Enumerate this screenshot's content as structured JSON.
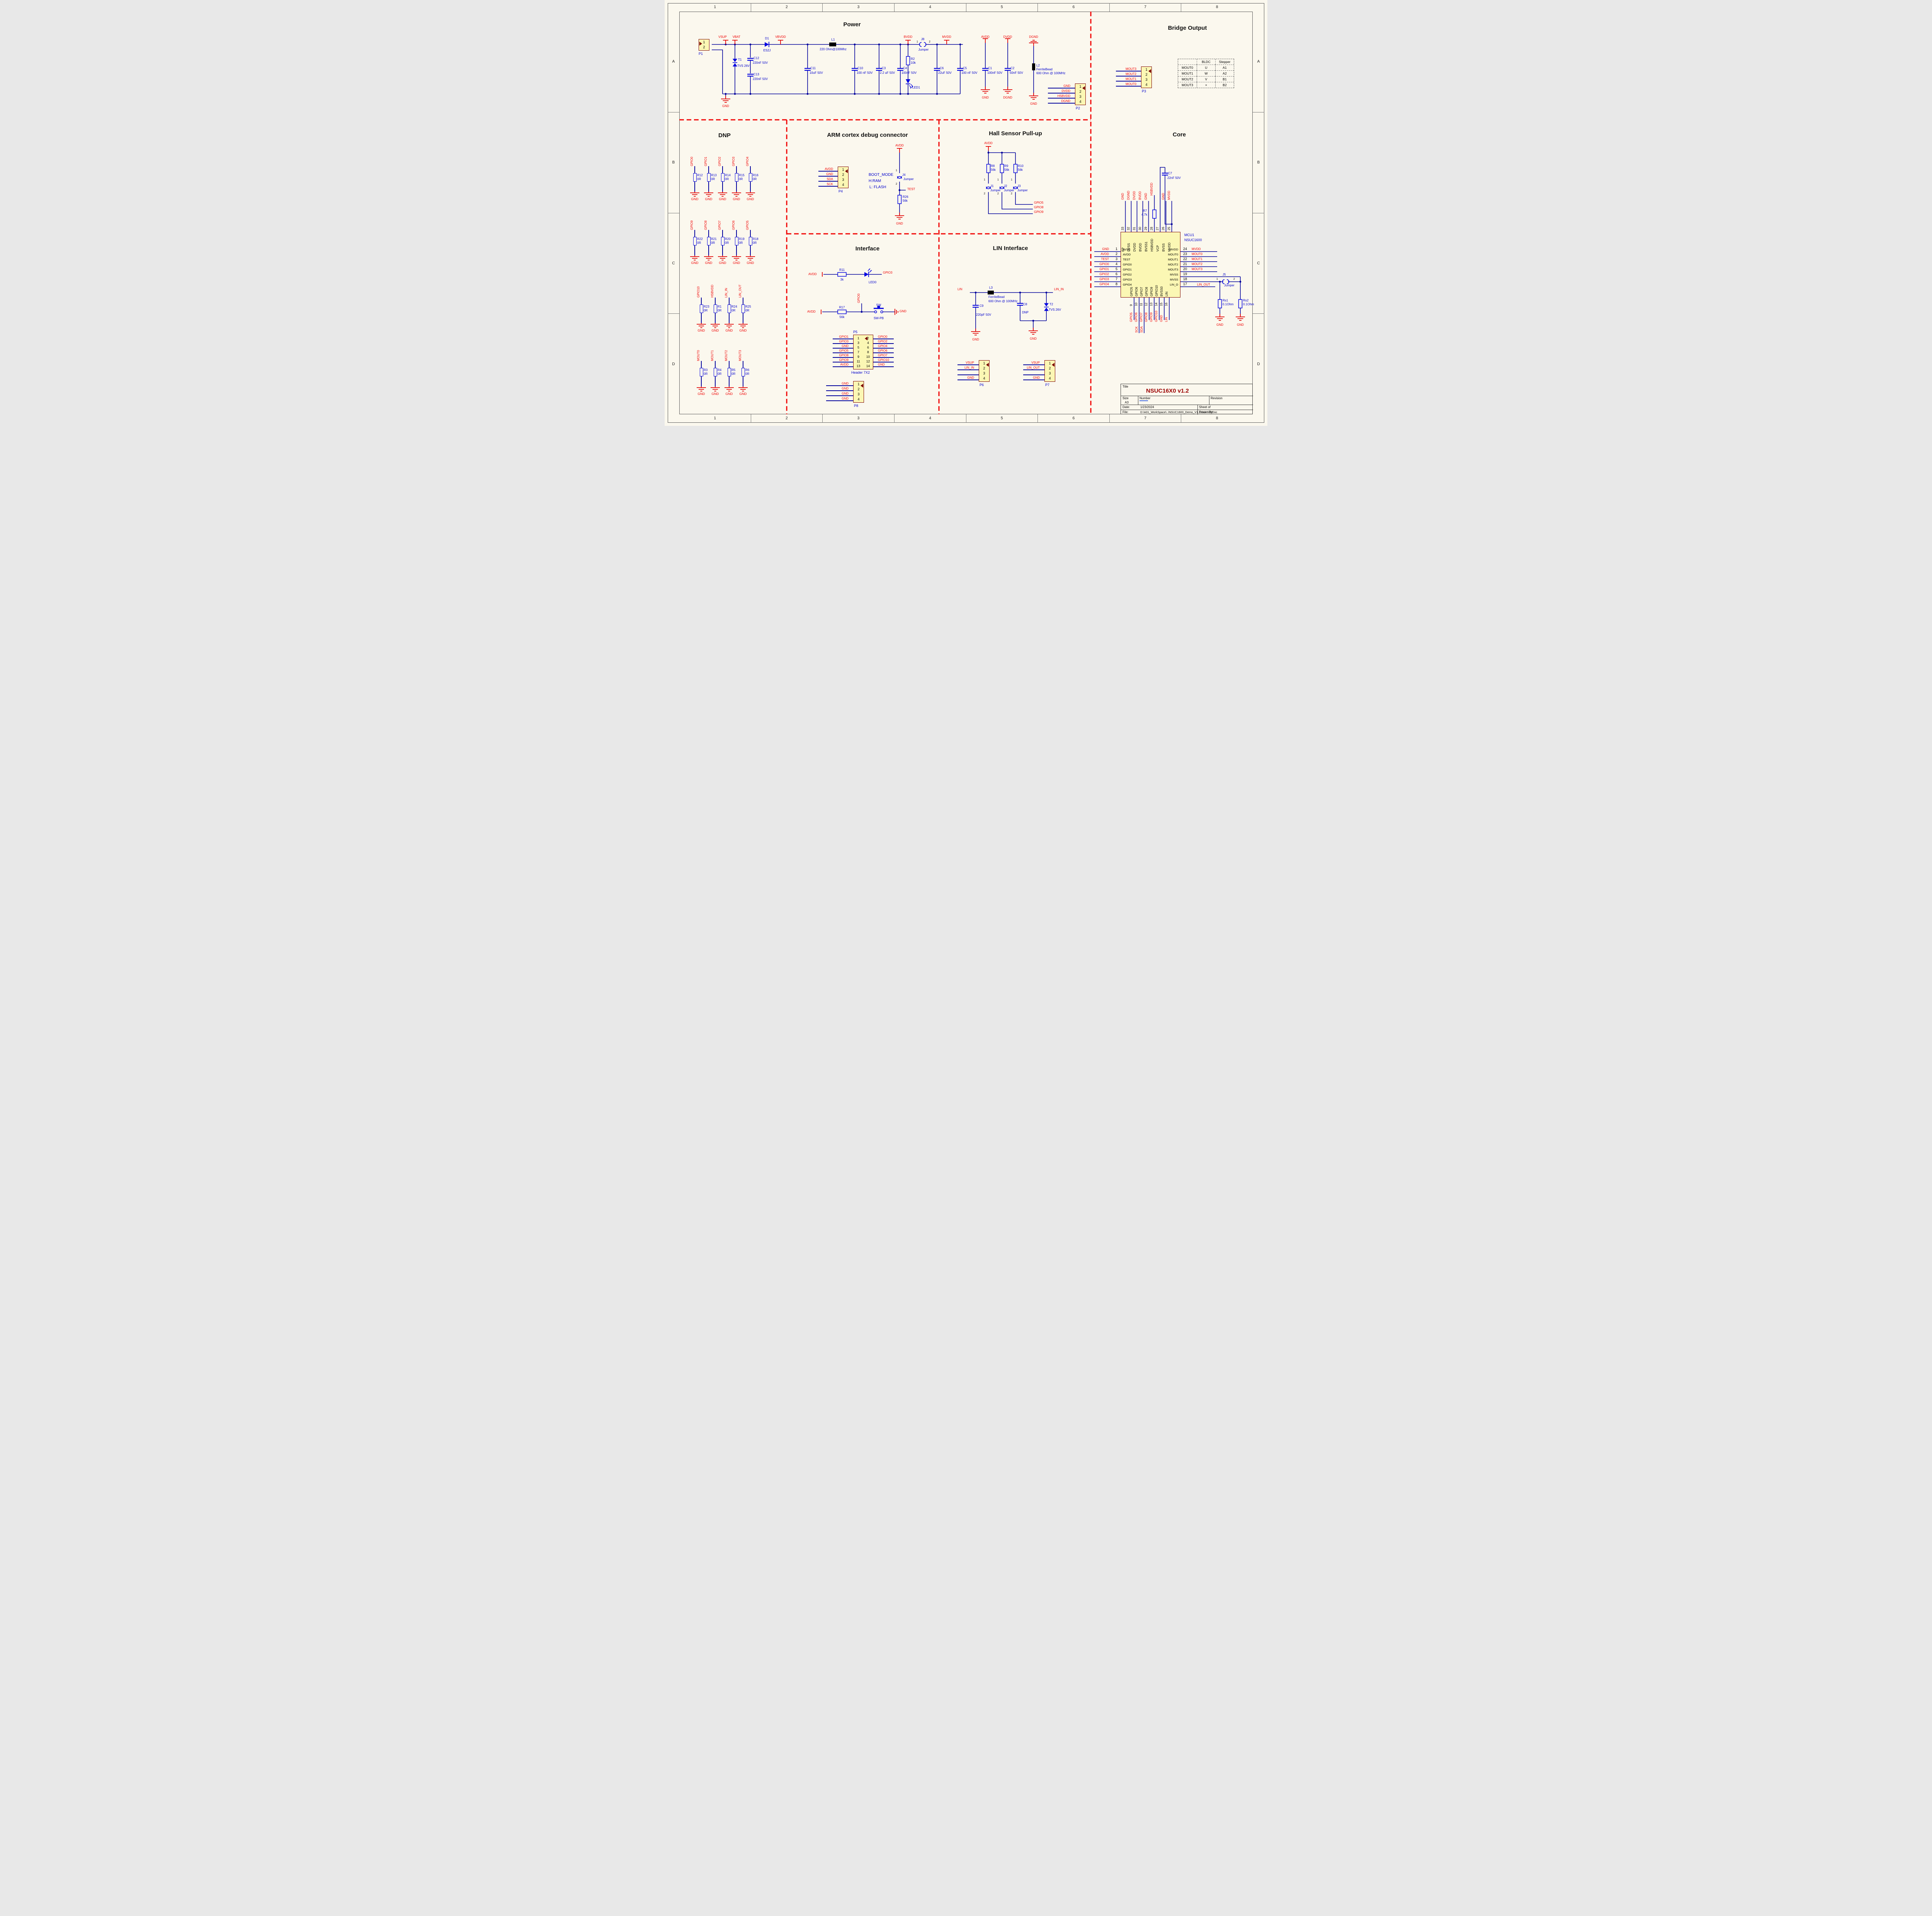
{
  "frame": {
    "cols": [
      "1",
      "2",
      "3",
      "4",
      "5",
      "6",
      "7",
      "8"
    ],
    "rows": [
      "A",
      "B",
      "C",
      "D"
    ]
  },
  "colors": {
    "wire": "#00009C",
    "symbol": "#0000E0",
    "net": "#F00000",
    "body_fill": "#FBF7B4",
    "body_border": "#7B0000",
    "title_red": "#9B0000",
    "sheet_bg": "#FBF8EE"
  },
  "sections": {
    "power": {
      "title": "Power"
    },
    "bridge": {
      "title": "Bridge Output"
    },
    "dnp": {
      "title": "DNP"
    },
    "arm": {
      "title": "ARM cortex debug connector"
    },
    "hall": {
      "title": "Hall Sensor Pull-up"
    },
    "core": {
      "title": "Core"
    },
    "interface": {
      "title": "Interface"
    },
    "lin": {
      "title": "LIN Interface"
    }
  },
  "power": {
    "p1": {
      "ref": "P1",
      "pins": [
        {
          "n": "1",
          "net": ""
        },
        {
          "n": "2",
          "net": ""
        }
      ]
    },
    "vsup": "VSUP",
    "vbat": "VBAT",
    "gnd": "GND",
    "t1": {
      "ref": "T1",
      "val": "TVS 26V"
    },
    "c12": {
      "ref": "C12",
      "val": "220nF 50V"
    },
    "c13": {
      "ref": "C13",
      "val": "220nF 50V"
    },
    "d1": {
      "ref": "D1",
      "val": "ES2J"
    },
    "vbvdd": "VBVDD",
    "c11": {
      "ref": "C11",
      "val": "10uF 50V"
    },
    "l1": {
      "ref": "L1",
      "val": "220 Ohm@100Mhz"
    },
    "c10": {
      "ref": "C10",
      "val": "100 nF 50V"
    },
    "c3": {
      "ref": "C3",
      "val": "2.2 uF 50V"
    },
    "c4": {
      "ref": "C4",
      "val": "100nF 50V"
    },
    "r2": {
      "ref": "R2",
      "val": "10k"
    },
    "led1": "LED1",
    "bvdd": "BVDD",
    "j8": {
      "ref": "J8",
      "val": "Jumper",
      "p1": "1",
      "p2": "2"
    },
    "mvdd": "MVDD",
    "c6": {
      "ref": "C6",
      "val": "22uF 50V"
    },
    "c5": {
      "ref": "C5",
      "val": "100 nF 50V"
    },
    "avdd": "AVDD",
    "c1": {
      "ref": "C1",
      "val": "100nF 50V"
    },
    "gnd2": "GND",
    "dvdd": "DVDD",
    "c2": {
      "ref": "C2",
      "val": "50nF 50V"
    },
    "dgnd2": "DGND",
    "dgnd": "DGND",
    "l2": {
      "ref": "L2",
      "val": "FerriteBead",
      "val2": "600 Ohm @ 100MHz"
    },
    "gnd3": "GND",
    "p2": {
      "ref": "P2",
      "pins": [
        {
          "n": "1",
          "net": "GND"
        },
        {
          "n": "2",
          "net": "DVDD"
        },
        {
          "n": "3",
          "net": "HSBVDD"
        },
        {
          "n": "4",
          "net": "DGND"
        }
      ]
    }
  },
  "bridge": {
    "p3": {
      "ref": "P3",
      "pins": [
        {
          "n": "1",
          "net": "MOUT3"
        },
        {
          "n": "2",
          "net": "MOUT2"
        },
        {
          "n": "3",
          "net": "MOUT1"
        },
        {
          "n": "4",
          "net": "MOUT0"
        }
      ]
    },
    "table": {
      "headers": [
        "",
        "BLDC",
        "Stepper"
      ],
      "rows": [
        [
          "MOUT0",
          "U",
          "A1"
        ],
        [
          "MOUT1",
          "W",
          "A2"
        ],
        [
          "MOUT2",
          "V",
          "B1"
        ],
        [
          "MOUT3",
          "×",
          "B2"
        ]
      ]
    }
  },
  "dnp": {
    "row1": [
      {
        "net": "GPIO0",
        "ref": "R12",
        "val": "0R",
        "gnd": "GND"
      },
      {
        "net": "GPIO1",
        "ref": "R13",
        "val": "0R",
        "gnd": "GND"
      },
      {
        "net": "GPIO2",
        "ref": "R14",
        "val": "0R",
        "gnd": "GND"
      },
      {
        "net": "GPIO3",
        "ref": "R15",
        "val": "0R",
        "gnd": "GND"
      },
      {
        "net": "GPIO4",
        "ref": "R16",
        "val": "0R",
        "gnd": "GND"
      }
    ],
    "row2": [
      {
        "net": "GPIO9",
        "ref": "R22",
        "val": "0R",
        "gnd": "GND"
      },
      {
        "net": "GPIO8",
        "ref": "R21",
        "val": "0R",
        "gnd": "GND"
      },
      {
        "net": "GPIO7",
        "ref": "R20",
        "val": "0R",
        "gnd": "GND"
      },
      {
        "net": "GPIO6",
        "ref": "R19",
        "val": "0R",
        "gnd": "GND"
      },
      {
        "net": "GPIO5",
        "ref": "R18",
        "val": "0R",
        "gnd": "GND"
      }
    ],
    "row3": [
      {
        "net": "GPIO10",
        "ref": "R23",
        "val": "0R",
        "gnd": "GND"
      },
      {
        "net": "HSBVDD",
        "ref": "R1",
        "val": "0R",
        "gnd": "GND"
      },
      {
        "net": "LIN_IN",
        "ref": "R24",
        "val": "0R",
        "gnd": "GND"
      },
      {
        "net": "LIN_OUT",
        "ref": "R25",
        "val": "0R",
        "gnd": "GND"
      }
    ],
    "row4": [
      {
        "net": "MOUT0",
        "ref": "R3",
        "val": "0R",
        "gnd": "GND"
      },
      {
        "net": "MOUT1",
        "ref": "R4",
        "val": "0R",
        "gnd": "GND"
      },
      {
        "net": "MOUT2",
        "ref": "R5",
        "val": "0R",
        "gnd": "GND"
      },
      {
        "net": "MOUT3",
        "ref": "R6",
        "val": "0R",
        "gnd": "GND"
      }
    ]
  },
  "arm": {
    "p4": {
      "ref": "P4",
      "pins": [
        {
          "n": "1",
          "net": "AVDD"
        },
        {
          "n": "2",
          "net": "GND"
        },
        {
          "n": "3",
          "net": "SDA"
        },
        {
          "n": "4",
          "net": "SCK"
        }
      ]
    },
    "avdd": "AVDD",
    "boot1": "BOOT_MODE",
    "boot2": "H:RAM",
    "boot3": "L: FLASH",
    "j4": {
      "ref": "J4",
      "val": "Jumper",
      "p1": "1",
      "p2": "2"
    },
    "test": "TEST",
    "r26": {
      "ref": "R26",
      "val": "56k"
    },
    "gnd": "GND"
  },
  "hall": {
    "avdd": "AVDD",
    "cols": [
      {
        "ref": "R8",
        "val": "56k",
        "j": "J1",
        "jn": "Jumper",
        "p1": "1",
        "p2": "2"
      },
      {
        "ref": "R9",
        "val": "56k",
        "j": "J2",
        "jn": "Jumper",
        "p1": "1",
        "p2": "2"
      },
      {
        "ref": "R10",
        "val": "56k",
        "j": "J3",
        "jn": "Jumper",
        "p1": "1",
        "p2": "2"
      }
    ],
    "out": [
      "GPIO5",
      "GPIO8",
      "GPIO9"
    ]
  },
  "interface": {
    "avdd1": "AVDD",
    "r11": {
      "ref": "R11",
      "val": "3k"
    },
    "led0": "LED0",
    "gpio3": "GPIO3",
    "gpio0": "GPIO0",
    "avdd2": "AVDD",
    "r17": {
      "ref": "R17",
      "val": "56k"
    },
    "sw": "SW",
    "swpb": "SW-PB",
    "gnd": "GND",
    "p5": {
      "ref": "P5",
      "name": "Header 7X2",
      "left": [
        {
          "n": "1",
          "net": "GPIO1"
        },
        {
          "n": "3",
          "net": "GPIO3"
        },
        {
          "n": "5",
          "net": "GND"
        },
        {
          "n": "7",
          "net": "GPIO5"
        },
        {
          "n": "9",
          "net": "GPIO8"
        },
        {
          "n": "11",
          "net": "GPIO9"
        },
        {
          "n": "13",
          "net": "AVDD"
        }
      ],
      "right": [
        {
          "n": "2",
          "net": "GPIO0"
        },
        {
          "n": "4",
          "net": "GPIO2"
        },
        {
          "n": "6",
          "net": "GPIO4"
        },
        {
          "n": "8",
          "net": "GPIO6"
        },
        {
          "n": "10",
          "net": "GPIO7"
        },
        {
          "n": "12",
          "net": "GPIO10"
        },
        {
          "n": "14",
          "net": "GND"
        }
      ]
    },
    "p8": {
      "ref": "P8",
      "pins": [
        {
          "n": "1",
          "net": "GND"
        },
        {
          "n": "2",
          "net": "GND"
        },
        {
          "n": "3",
          "net": "GND"
        },
        {
          "n": "4",
          "net": "GND"
        }
      ]
    }
  },
  "lin": {
    "lin": "LIN",
    "l3": {
      "ref": "L3",
      "val": "FerriteBead",
      "val2": "600 Ohm @ 100MHz"
    },
    "c9": {
      "ref": "C9",
      "val": "220pF 50V"
    },
    "gnd1": "GND",
    "c8": {
      "ref": "C8",
      "val": "DNP"
    },
    "t2": {
      "ref": "T2",
      "val": "TVS 26V"
    },
    "gnd2": "GND",
    "lin_in": "LIN_IN",
    "p6": {
      "ref": "P6",
      "pins": [
        {
          "n": "1",
          "net": "VSUP"
        },
        {
          "n": "2",
          "net": "LIN_IN"
        },
        {
          "n": "3",
          "net": ""
        },
        {
          "n": "4",
          "net": "GND"
        }
      ]
    },
    "p7": {
      "ref": "P7",
      "pins": [
        {
          "n": "1",
          "net": "VSUP"
        },
        {
          "n": "2",
          "net": "LIN_OUT"
        },
        {
          "n": "3",
          "net": ""
        },
        {
          "n": "4",
          "net": "GND"
        }
      ]
    }
  },
  "core": {
    "mcu": {
      "ref": "MCU1",
      "part": "NSUC1600"
    },
    "top_nets": [
      "GND",
      "DGND",
      "DVDD",
      "BVDD",
      "GND",
      "",
      "",
      "GND",
      "MVDD"
    ],
    "top_nums": [
      "33",
      "32",
      "31",
      "30",
      "29",
      "28",
      "27",
      "26",
      "25"
    ],
    "top_names": [
      "EP",
      "DVSS",
      "DVDD",
      "BVDD",
      "BVSS1",
      "HSBVDD",
      "VCP",
      "BVSS",
      "MVDD"
    ],
    "left": [
      {
        "num": "1",
        "name": "AVSS",
        "net": "GND"
      },
      {
        "num": "2",
        "name": "AVDD",
        "net": "AVDD"
      },
      {
        "num": "3",
        "name": "TEST",
        "net": "TEST"
      },
      {
        "num": "4",
        "name": "GPIO0",
        "net": "GPIO0"
      },
      {
        "num": "5",
        "name": "GPIO1",
        "net": "GPIO1"
      },
      {
        "num": "6",
        "name": "GPIO2",
        "net": "GPIO2"
      },
      {
        "num": "7",
        "name": "GPIO3",
        "net": "GPIO3"
      },
      {
        "num": "8",
        "name": "GPIO4",
        "net": "GPIO4"
      }
    ],
    "right": [
      {
        "num": "24",
        "name": "MVDD",
        "net": "MVDD"
      },
      {
        "num": "23",
        "name": "MOUT0",
        "net": "MOUT0"
      },
      {
        "num": "22",
        "name": "MOUT1",
        "net": "MOUT1"
      },
      {
        "num": "21",
        "name": "MOUT2",
        "net": "MOUT2"
      },
      {
        "num": "20",
        "name": "MOUT3",
        "net": "MOUT3"
      },
      {
        "num": "19",
        "name": "MVSS",
        "net": ""
      },
      {
        "num": "18",
        "name": "MVSS",
        "net": ""
      },
      {
        "num": "17",
        "name": "LIN_O",
        "net": ""
      }
    ],
    "bottom_names": [
      "GPIO5",
      "GPIO6",
      "GPIO7",
      "GPIO8",
      "GPIO9",
      "GPIO10",
      "BVSS0",
      "LIN"
    ],
    "bottom_nums": [
      "9",
      "10",
      "11",
      "12",
      "13",
      "14",
      "15",
      "16"
    ],
    "bottom_nets": [
      "GPIO5",
      "GPIO6",
      "GPIO7",
      "GPIO8",
      "GPIO9",
      "GPIO10",
      "GND",
      "LIN"
    ],
    "sck": "SCK",
    "sda": "SDA",
    "hsbvdd": "HSBVDD",
    "r7": {
      "ref": "R7",
      "val": "4.7k"
    },
    "c7": {
      "ref": "C7",
      "val": "22nF 50V"
    },
    "j5": {
      "ref": "J5",
      "val": "Jumper",
      "p1": "1",
      "p2": "2"
    },
    "rs1": {
      "ref": "Rs1",
      "val": "0.1Ohm"
    },
    "rs2": {
      "ref": "Rs2",
      "val": "0.1Ohm"
    },
    "lin_out": "LIN_OUT",
    "gnd1": "GND",
    "gnd2": "GND"
  },
  "title_block": {
    "title_label": "Title",
    "title": "NSUC16X0 v1.2",
    "size_label": "Size",
    "size": "A3",
    "number_label": "Number",
    "revision_label": "Revision",
    "date_label": "Date:",
    "date": "1/23/2024",
    "sheet_label": "Sheet  of",
    "file_label": "File:",
    "file": "D:\\A01_WorkSpace\\..\\NSUC1600_Demo_V1.2\\Sch.SchDoc",
    "drawn_label": "Drawn By:"
  }
}
